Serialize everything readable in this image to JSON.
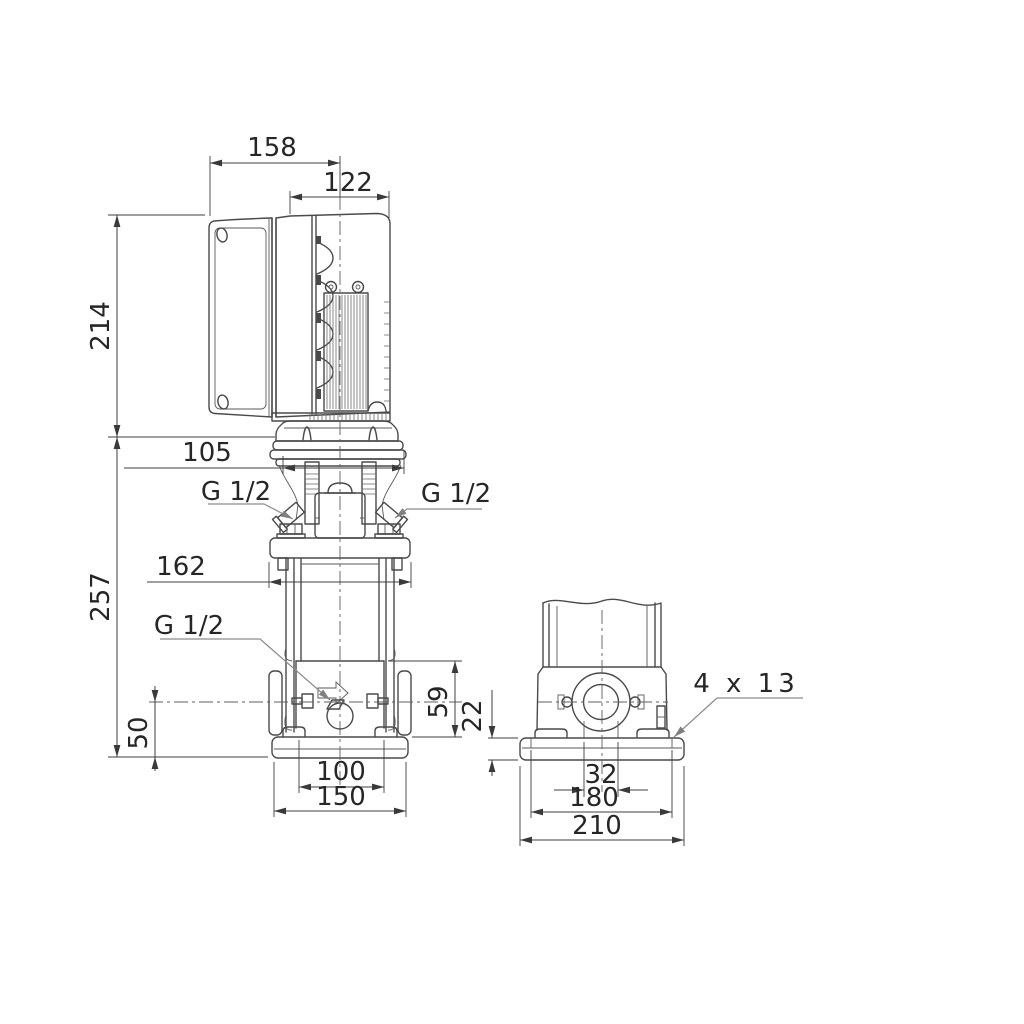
{
  "drawing": {
    "front_view": {
      "dims": {
        "motor_back_to_center": "158",
        "motor_width": "122",
        "motor_height": "214",
        "head_width": "105",
        "pump_height": "257",
        "flange_width": "162",
        "port_center_height": "50",
        "chamber_section_height": "59",
        "base_slot_span": "100",
        "base_width": "150"
      },
      "labels": {
        "plug_left": "G 1/2",
        "plug_right": "G 1/2",
        "drain_plug": "G 1/2"
      }
    },
    "side_view": {
      "dims": {
        "base_plate_thickness": "22",
        "port_bore": "32",
        "bolt_hole_span": "180",
        "base_depth": "210"
      },
      "labels": {
        "bolt_holes": "4 x 13"
      }
    },
    "colors": {
      "line": "#4a4a4a",
      "text": "#262626",
      "leader": "#8c8c8c",
      "background": "#ffffff"
    }
  }
}
